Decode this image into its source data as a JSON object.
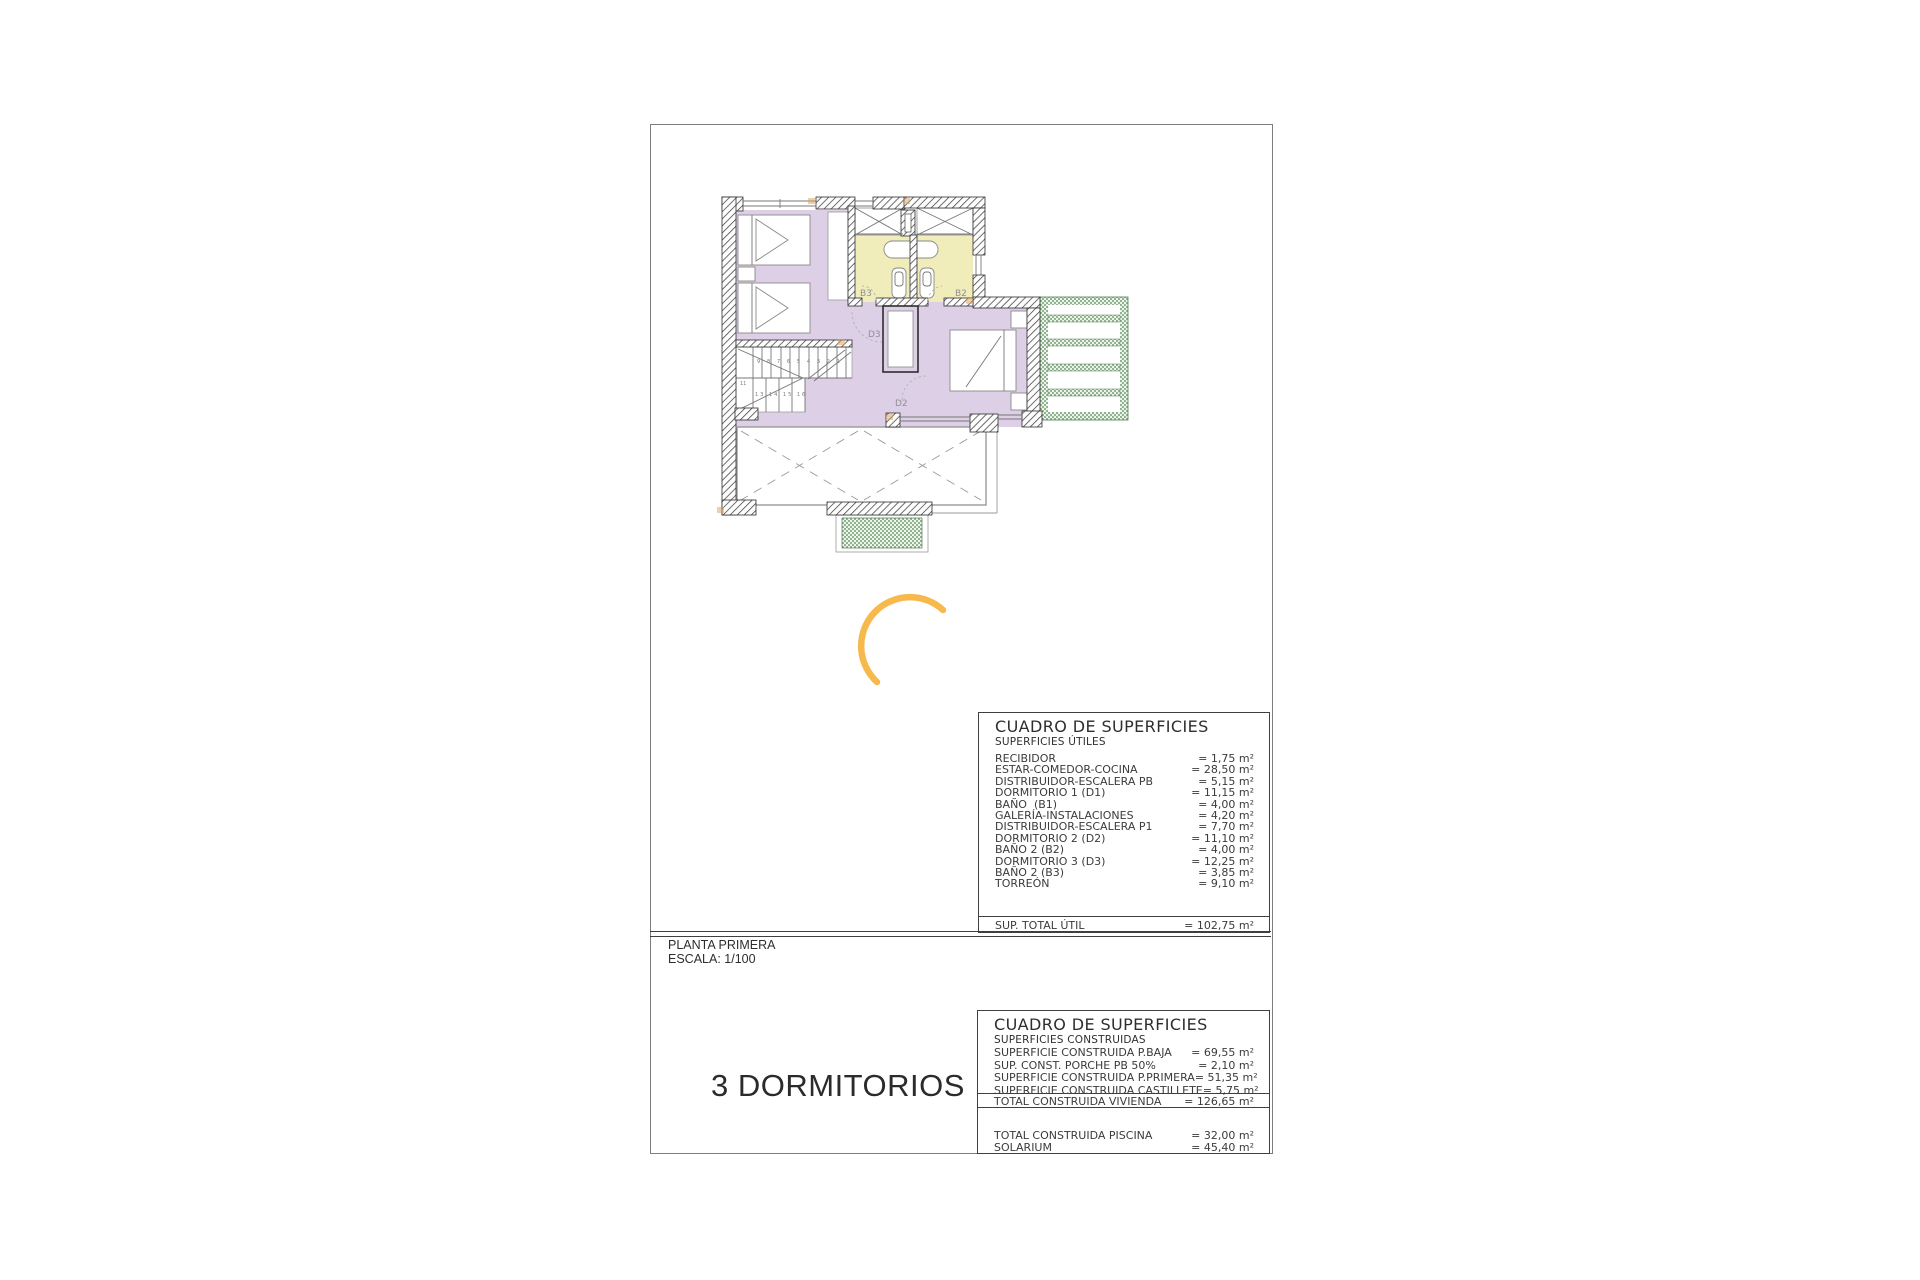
{
  "colors": {
    "room_purple": "#DCCFE6",
    "bath_yellow": "#F0EDBA",
    "pergola_green": "#8FB48F",
    "pergola_bg": "#EEF4EC",
    "arc_orange": "#F7B84C",
    "wall_line": "#3F3F3F"
  },
  "plan": {
    "labels": {
      "b3": "B3",
      "b2": "B2",
      "d3": "D3",
      "d2": "D2"
    },
    "stair_numbers_upper": "9 8 7 6 5 4 3 2 1",
    "stair_numbers_lower": "13 14 15 16",
    "stair_number_landing": "11"
  },
  "title_block": {
    "plan_name": "PLANTA PRIMERA",
    "scale": "ESCALA: 1/100",
    "variant": "3 DORMITORIOS"
  },
  "surface_tables": {
    "utiles": {
      "title": "CUADRO DE SUPERFICIES",
      "subtitle": "SUPERFICIES ÚTILES",
      "rows": [
        {
          "label": "RECIBIDOR",
          "value": "= 1,75 m²"
        },
        {
          "label": "ESTAR-COMEDOR-COCINA",
          "value": "= 28,50 m²"
        },
        {
          "label": "DISTRIBUIDOR-ESCALERA PB",
          "value": "= 5,15 m²"
        },
        {
          "label": "DORMITORIO 1 (D1)",
          "value": "= 11,15 m²"
        },
        {
          "label": "BAÑO  (B1)",
          "value": "= 4,00 m²"
        },
        {
          "label": "GALERÍA-INSTALACIONES",
          "value": "= 4,20 m²"
        },
        {
          "label": "DISTRIBUIDOR-ESCALERA P1",
          "value": "= 7,70 m²"
        },
        {
          "label": "DORMITORIO 2 (D2)",
          "value": "= 11,10 m²"
        },
        {
          "label": "BAÑO 2 (B2)",
          "value": "= 4,00 m²"
        },
        {
          "label": "DORMITORIO 3 (D3)",
          "value": "= 12,25 m²"
        },
        {
          "label": "BAÑO 2 (B3)",
          "value": "= 3,85 m²"
        },
        {
          "label": "TORREÓN",
          "value": "= 9,10 m²"
        }
      ],
      "total": {
        "label": "SUP. TOTAL ÚTIL",
        "value": "= 102,75 m²"
      }
    },
    "construidas": {
      "title": "CUADRO DE SUPERFICIES",
      "subtitle": "SUPERFICIES CONSTRUIDAS",
      "rows": [
        {
          "label": "SUPERFICIE CONSTRUIDA P.BAJA",
          "value": "= 69,55 m²"
        },
        {
          "label": "SUP. CONST. PORCHE PB 50%",
          "value": "= 2,10 m²"
        },
        {
          "label": "SUPERFICIE CONSTRUIDA P.PRIMERA",
          "value": "= 51,35 m²"
        },
        {
          "label": "SUPERFICIE CONSTRUIDA CASTILLETE",
          "value": "= 5,75 m²"
        }
      ],
      "total": {
        "label": "TOTAL CONSTRUIDA VIVIENDA",
        "value": "= 126,65 m²"
      },
      "extra_rows": [
        {
          "label": "TOTAL CONSTRUIDA PISCINA",
          "value": "= 32,00 m²"
        },
        {
          "label": "SOLARIUM",
          "value": "= 45,40 m²"
        }
      ]
    }
  }
}
